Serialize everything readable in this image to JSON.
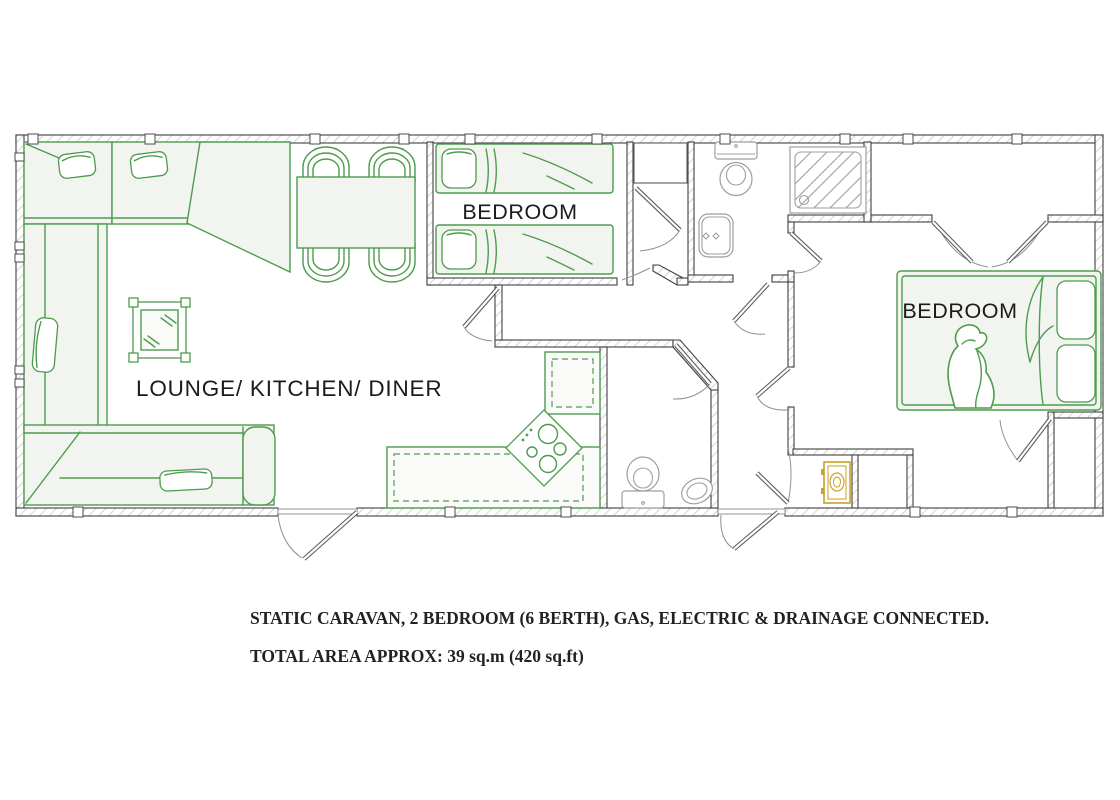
{
  "page_title": "Static Caravan Floor Plan",
  "plan": {
    "rooms": [
      {
        "id": "lounge",
        "label": "LOUNGE/ KITCHEN/ DINER"
      },
      {
        "id": "bedroom_twin",
        "label": "BEDROOM"
      },
      {
        "id": "bedroom_master",
        "label": "BEDROOM"
      }
    ],
    "furniture": [
      "corner-sofa",
      "dining-table",
      "dining-chairs",
      "mirror",
      "kitchen-counter",
      "hob",
      "twin-beds",
      "double-bed",
      "wardrobes",
      "person-figure"
    ],
    "fixtures": [
      "toilet",
      "wash-basin",
      "shower-tray",
      "toilet-2",
      "corner-basin",
      "boiler"
    ]
  },
  "captions": {
    "line1": "STATIC CARAVAN, 2 BEDROOM (6 BERTH), GAS, ELECTRIC & DRAINAGE CONNECTED.",
    "line2": "TOTAL AREA APPROX: 39 sq.m (420 sq.ft)"
  },
  "colors": {
    "background": "#ffffff",
    "furniture": "#4e9b4e",
    "furniture_light_fill": "#f2f4ef",
    "fixtures": "#9b9fa0",
    "walls": "#3f3f3f",
    "wall_hatch": "#c9c9c9",
    "boiler": "#c9a227",
    "label_text": "#1b1b1b",
    "caption_text": "#222222"
  }
}
